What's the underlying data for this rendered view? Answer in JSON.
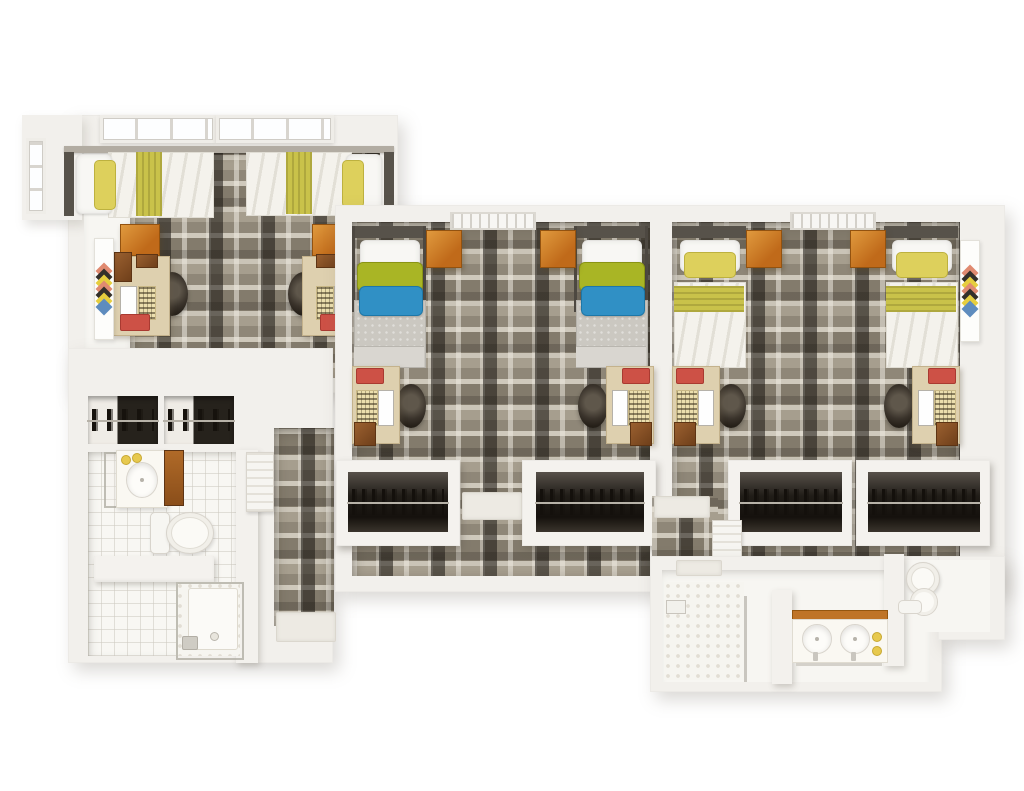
{
  "meta": {
    "title": "Dormitory suite floor plan",
    "render_style": "top-down 3D architectural render",
    "canvas": {
      "width": 1024,
      "height": 791
    }
  },
  "palette": {
    "wall": "#f2f0ec",
    "carpet_base": "#9a9283",
    "carpet_dark": "#2e2a24",
    "carpet_light": "#d7d2c7",
    "tile_floor": "#f8f7f3",
    "accent_orange": "#c97a28",
    "accent_red": "#cd5146",
    "accent_yellow": "#ddd05c",
    "accent_green": "#a9b525",
    "accent_blue": "#3090c5",
    "desk_wood": "#ded0af",
    "dark_clothes": "#14100c"
  },
  "rooms": [
    {
      "id": "bedroom-left",
      "label": "Left bedroom: two twin beds with yellow bedding, two desks with laptops and chairs, two orange dressers, diamond wall art, windows"
    },
    {
      "id": "bedroom-middle",
      "label": "Middle bedroom: two twin beds with green and blue pillows, orange side tables, two desks with laptops, two closets with hanging clothes, ceiling vent"
    },
    {
      "id": "bedroom-right",
      "label": "Right bedroom: two twin beds with yellow bedding, orange side tables, two desks with laptops, two closets with hanging clothes, diamond wall art, ceiling vent"
    },
    {
      "id": "bathroom-left",
      "label": "Lower-left bathroom: vanity sink with wood cabinet, toilet, bench counter, glass shower, two closets with hanging clothes"
    },
    {
      "id": "bathroom-right",
      "label": "Lower-right bathroom: tiled shower, double-sink vanity with wood edge, toilet stall behind partitions"
    },
    {
      "id": "hallway",
      "label": "Carpeted hallway with wall heater unit and entry door mats"
    }
  ]
}
